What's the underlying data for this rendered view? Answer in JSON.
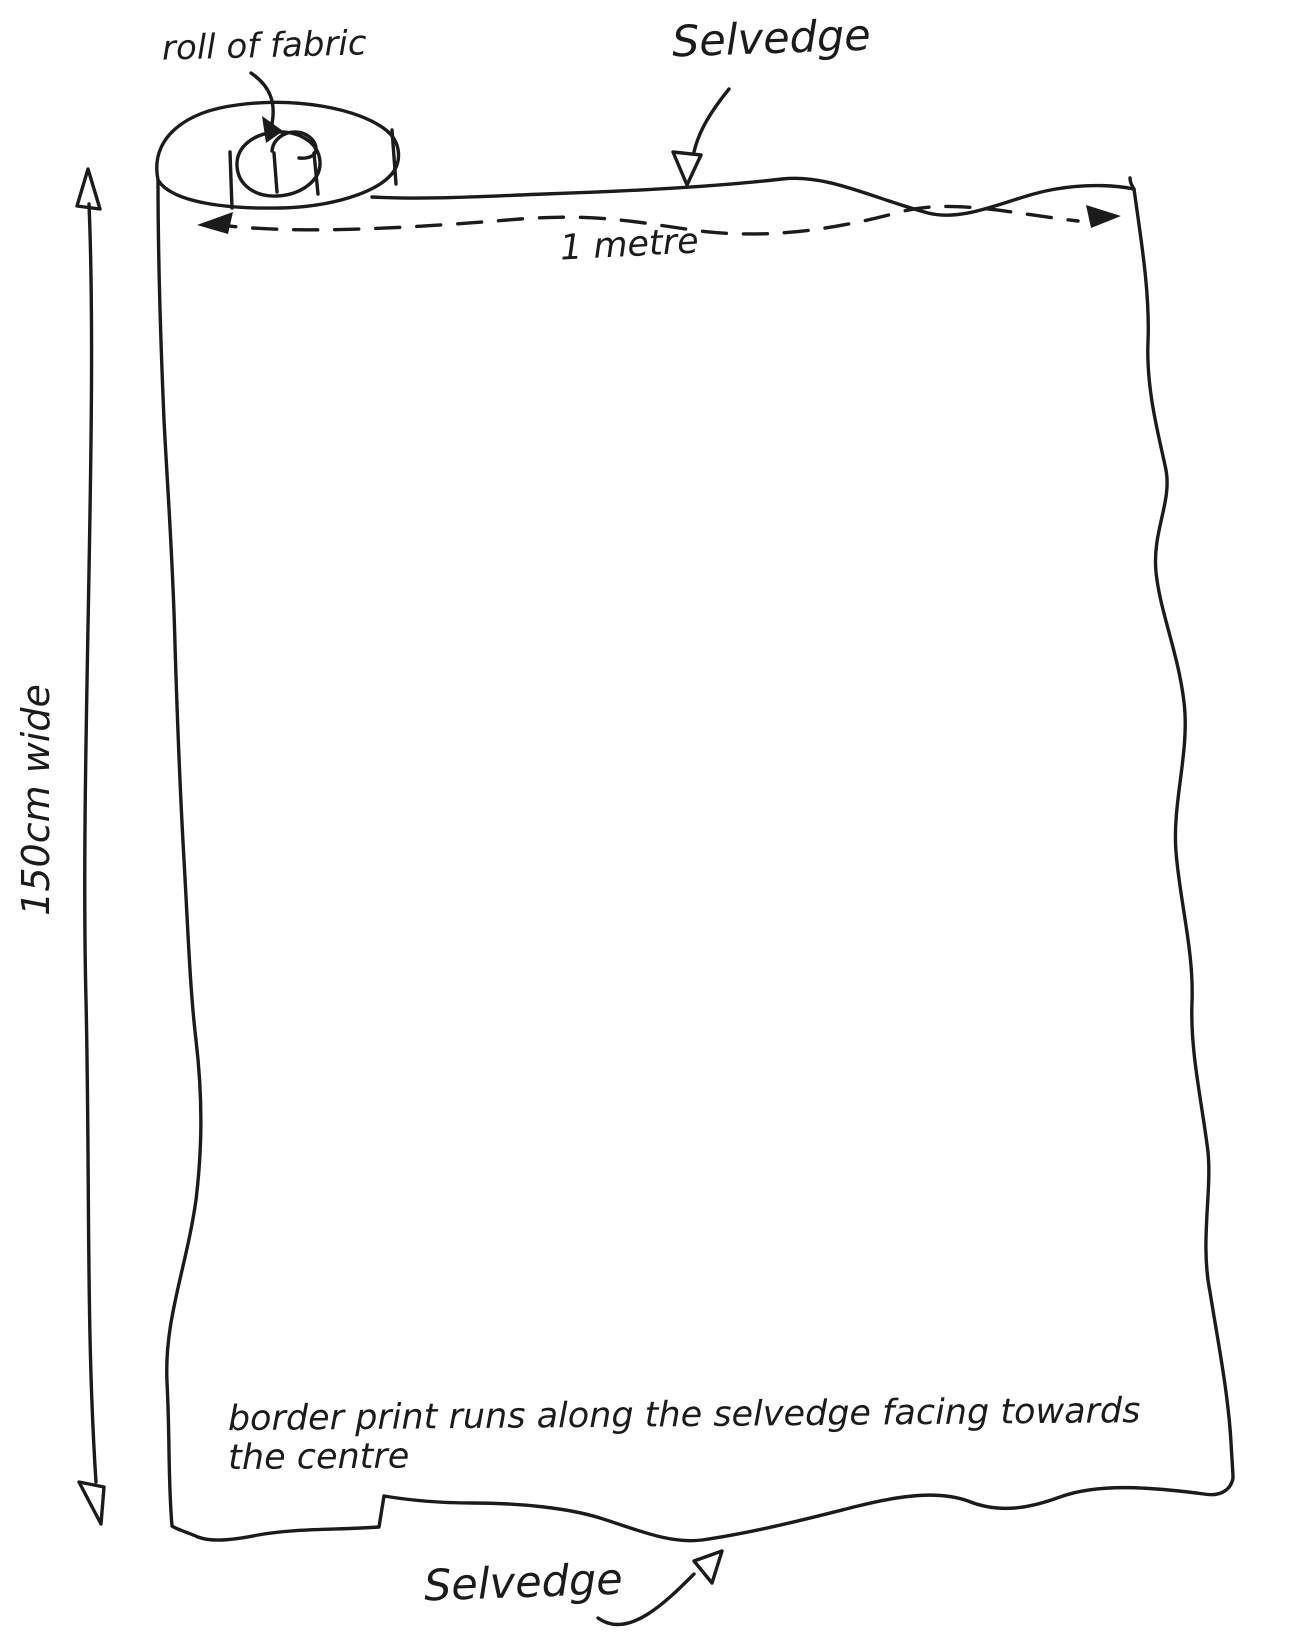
{
  "diagram": {
    "type": "hand-drawn fabric layout sketch",
    "labels": {
      "roll": "roll of fabric",
      "selvedge_top": "Selvedge",
      "one_metre": "1 metre",
      "width": "150cm wide",
      "border_print": "border print runs along the selvedge facing towards the centre",
      "selvedge_bottom": "Selvedge"
    },
    "measurements": {
      "width_along_selvedge": "1 metre",
      "fabric_width": "150cm"
    },
    "colors": {
      "ink": "#1b1b1b",
      "background": "#ffffff"
    }
  }
}
